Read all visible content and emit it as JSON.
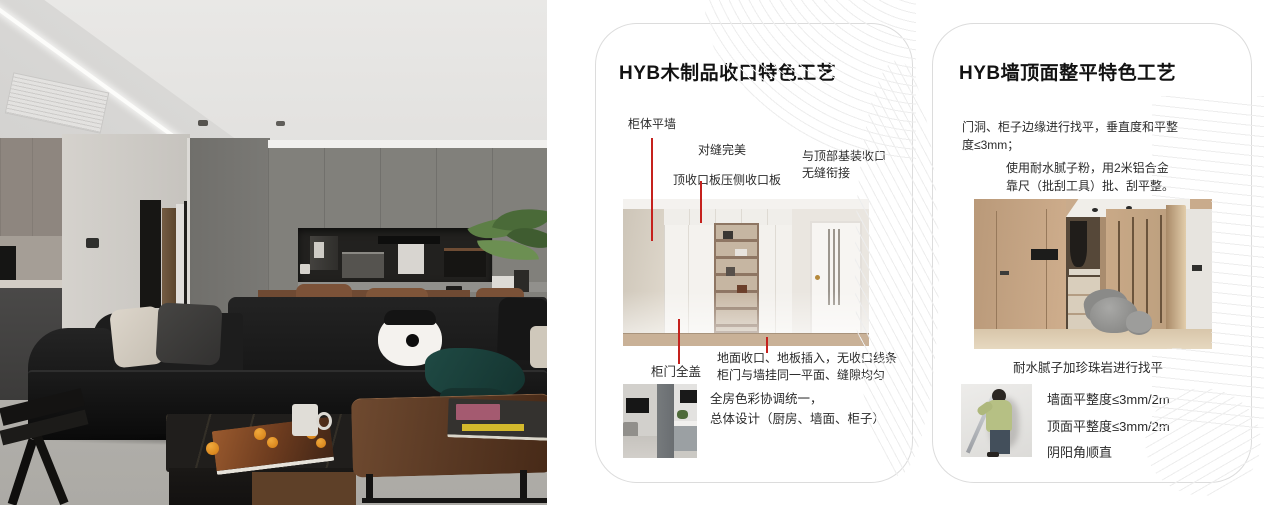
{
  "colors": {
    "accent_red": "#c5211d",
    "card_border": "#dcdcdc",
    "pattern_line": "#ededed"
  },
  "cards": [
    {
      "title": "HYB木制品收口特色工艺",
      "callouts": {
        "cabinet_flush_wall": "柜体平墙",
        "perfect_seam": "对缝完美",
        "top_closing_board": "顶收口板压侧收口板",
        "top_joint_line1": "与顶部基装收口",
        "top_joint_line2": "无缝衔接",
        "full_cover_door": "柜门全盖"
      },
      "floor_note_line1": "地面收口、地板插入，无收口线条",
      "floor_note_line2": "柜门与墙挂同一平面、缝隙均匀",
      "color_note_line1": "全房色彩协调统一，",
      "color_note_line2": "总体设计（厨房、墙面、柜子）"
    },
    {
      "title": "HYB墙顶面整平特色工艺",
      "para1_line1": "门洞、柜子边缘进行找平，垂直度和平整",
      "para1_line2": "度≤3mm；",
      "para2_line1": "使用耐水腻子粉，用2米铝合金",
      "para2_line2": "靠尺（批刮工具）批、刮平整。",
      "photo_caption": "耐水腻子加珍珠岩进行找平",
      "spec_line1": "墙面平整度≤3mm/2m",
      "spec_line2": "顶面平整度≤3mm/2m",
      "spec_line3": "阴阳角顺直"
    }
  ]
}
